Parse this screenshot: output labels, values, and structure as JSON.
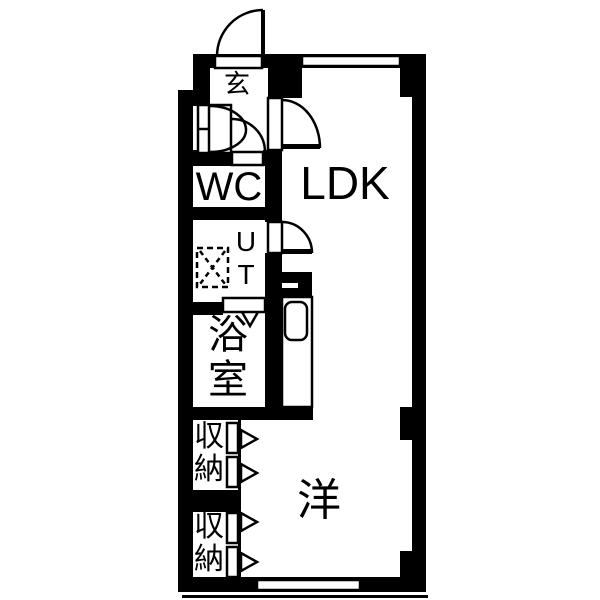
{
  "floorplan": {
    "title": "apartment-floorplan",
    "rooms": {
      "entrance": {
        "label": "玄"
      },
      "wc": {
        "label": "WC"
      },
      "utility": {
        "label": "U\nT"
      },
      "bathroom": {
        "label": "浴\n室"
      },
      "closet1": {
        "label": "収\n納"
      },
      "closet2": {
        "label": "収\n納"
      },
      "ldk": {
        "label": "LDK"
      },
      "western_room": {
        "label": "洋"
      }
    },
    "colors": {
      "wall": "#000000",
      "background": "#ffffff",
      "line": "#000000"
    }
  }
}
